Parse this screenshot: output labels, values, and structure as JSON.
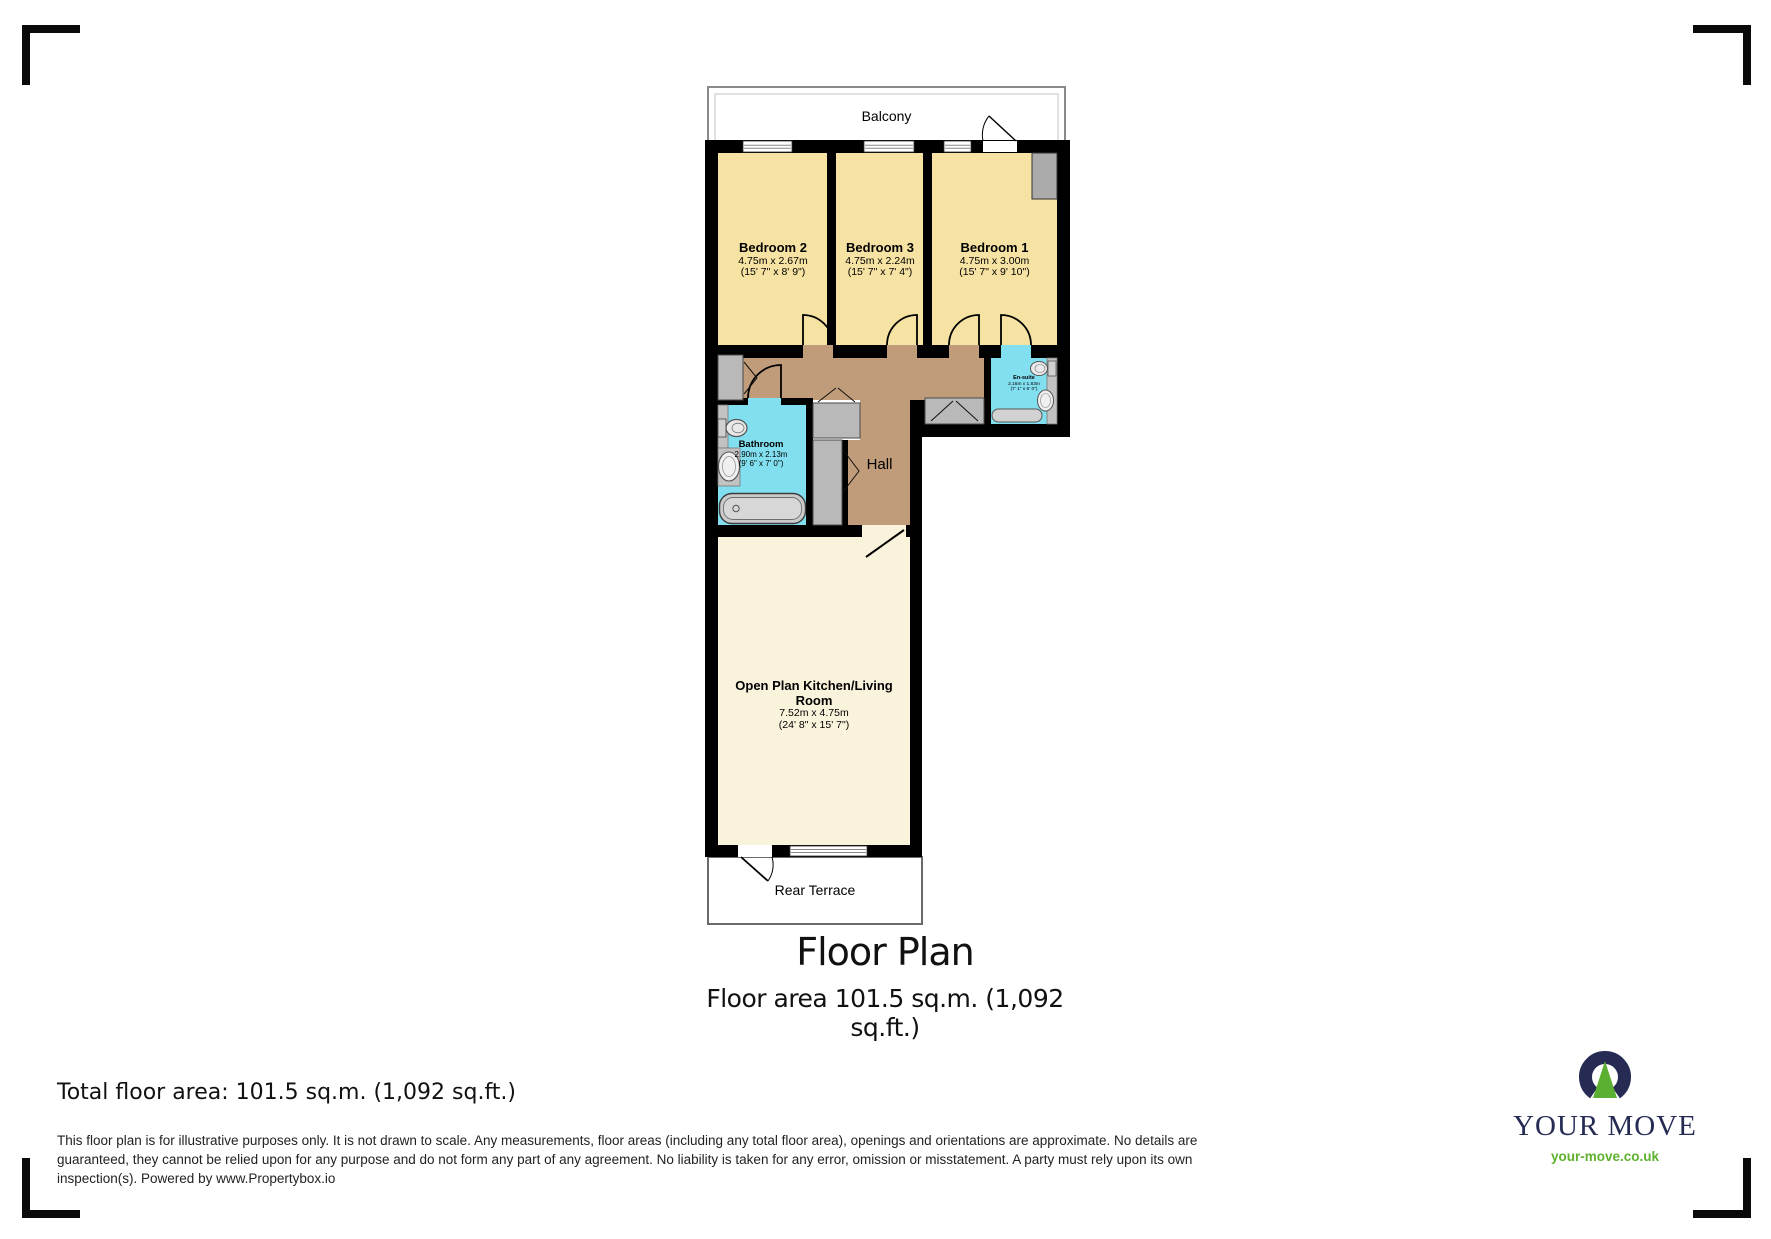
{
  "caption": {
    "title": "Floor Plan",
    "subtitle_line1": "Floor area 101.5 sq.m. (1,092",
    "subtitle_line2": "sq.ft.)"
  },
  "total_area": "Total floor area: 101.5 sq.m. (1,092 sq.ft.)",
  "disclaimer": {
    "line1": "This floor plan is for illustrative purposes only. It is not drawn to scale. Any measurements, floor areas (including any total floor area), openings and orientations are approximate. No details are",
    "line2": "guaranteed, they cannot be relied upon for any purpose and do not form any part of any agreement. No liability is taken for any error, omission or misstatement. A party must rely upon its own",
    "line3": "inspection(s). Powered by www.Propertybox.io"
  },
  "branding": {
    "name": "YOUR MOVE",
    "url": "your-move.co.uk"
  },
  "rooms": {
    "balcony": {
      "label": "Balcony"
    },
    "bedroom2": {
      "name": "Bedroom 2",
      "dims_m": "4.75m x 2.67m",
      "dims_ft": "(15' 7\" x 8' 9\")"
    },
    "bedroom3": {
      "name": "Bedroom 3",
      "dims_m": "4.75m x 2.24m",
      "dims_ft": "(15' 7\" x 7' 4\")"
    },
    "bedroom1": {
      "name": "Bedroom 1",
      "dims_m": "4.75m x 3.00m",
      "dims_ft": "(15' 7\" x 9' 10\")"
    },
    "bathroom": {
      "name": "Bathroom",
      "dims_m": "2.90m x 2.13m",
      "dims_ft": "(9' 6\" x 7' 0\")"
    },
    "ensuite": {
      "name": "En-suite",
      "dims_m": "2.16m x 1.83m",
      "dims_ft": "(7' 1\" x 6' 0\")"
    },
    "hall": {
      "label": "Hall"
    },
    "living": {
      "name": "Open Plan Kitchen/Living Room",
      "dims_m": "7.52m x 4.75m",
      "dims_ft": "(24' 8\" x 15' 7\")"
    },
    "terrace": {
      "label": "Rear Terrace"
    }
  },
  "colors": {
    "wall": "#000000",
    "bedroom_fill": "#F6E2A2",
    "living_fill": "#FAF3DC",
    "hall_fill": "#C09C7A",
    "bath_fill": "#82DFEF",
    "fixture_gray": "#C2C2C2",
    "brand_navy": "#262B54",
    "brand_green": "#5FB12E"
  }
}
